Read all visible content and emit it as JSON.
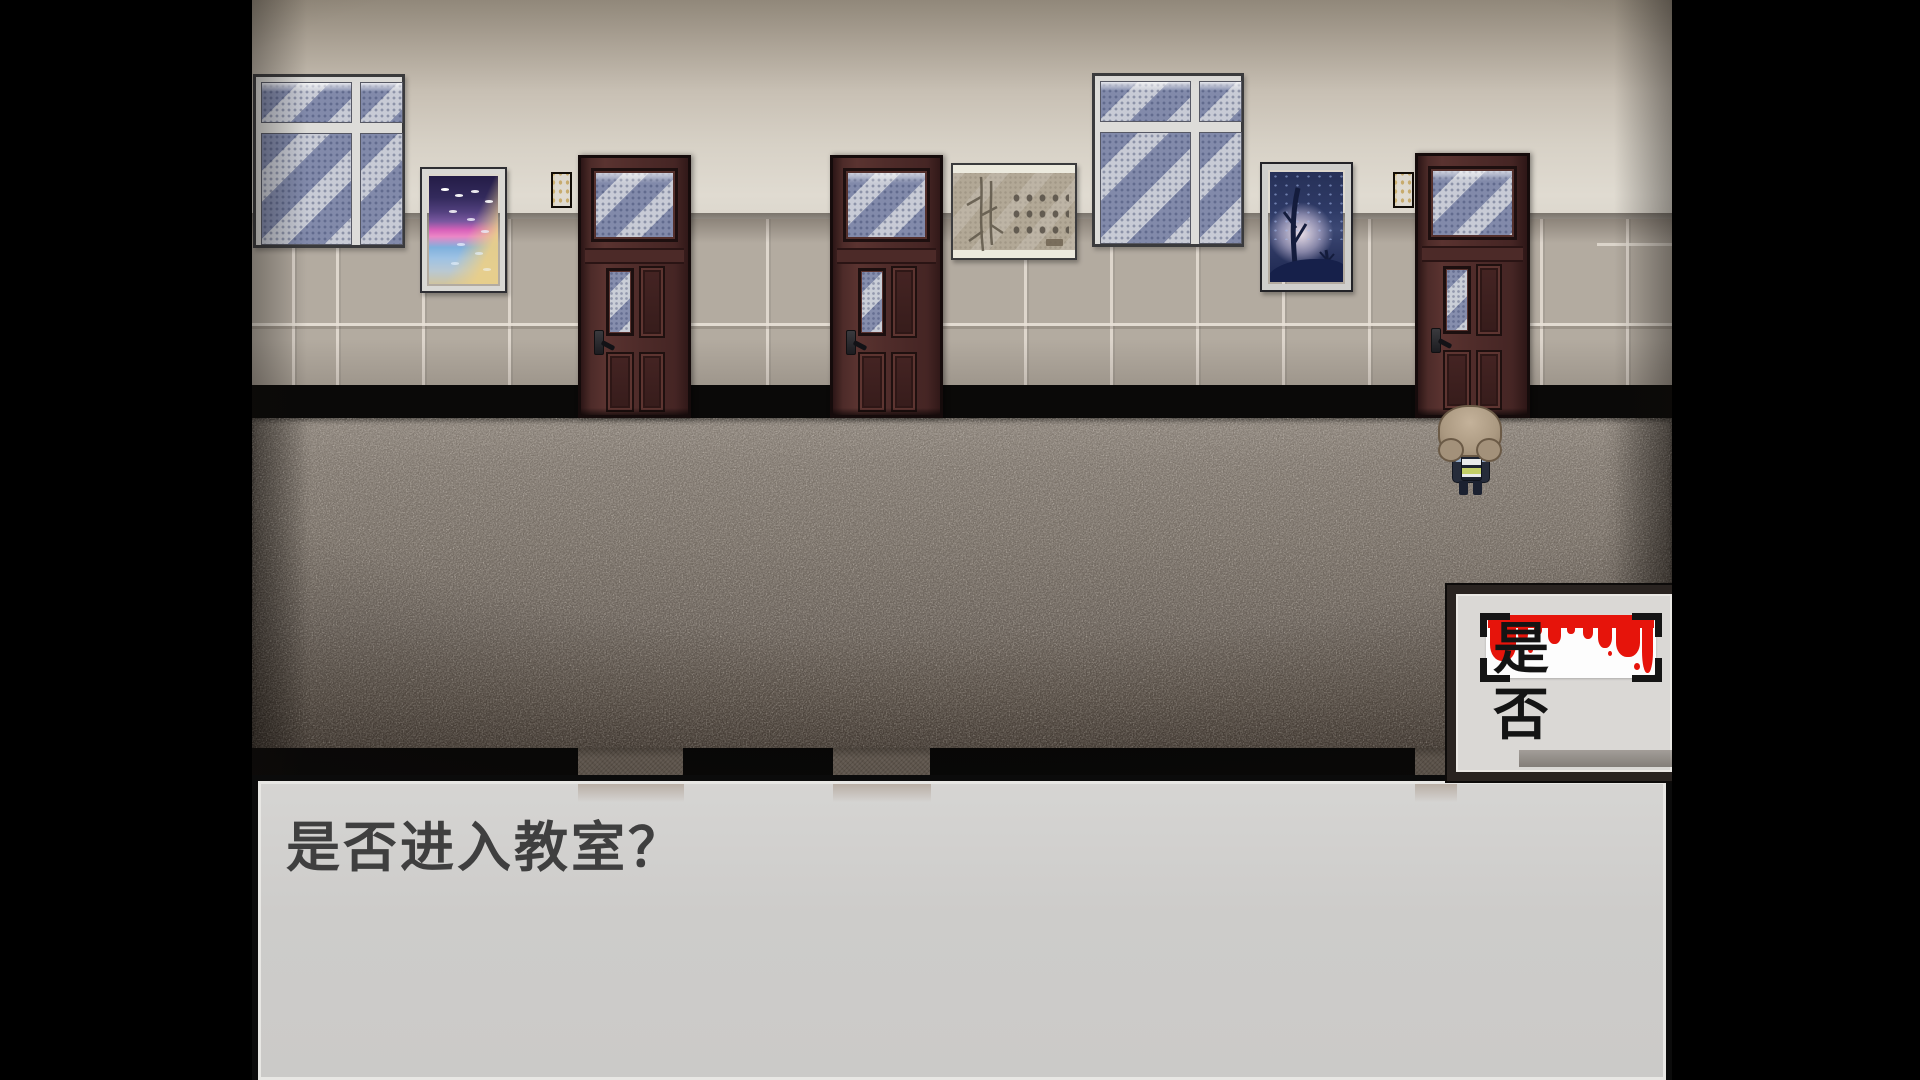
{
  "dialogue": {
    "text": "是否进入教室？"
  },
  "choices": {
    "options": [
      {
        "label": "是",
        "selected": true
      },
      {
        "label": "否",
        "selected": false
      }
    ],
    "selected_index": 0
  },
  "scene": {
    "type": "school-hallway",
    "player": "pixel character with fluffy tan hair and dark uniform, seen from behind at the right classroom door",
    "door_count": 3,
    "window_count": 2,
    "plaque_count": 2,
    "posters": [
      "seaside-sunset-painting",
      "calligraphy-scroll",
      "night-trees-painting"
    ],
    "colors": {
      "letterbox": "#000000",
      "wall_top": "#a1988a",
      "wall_light": "#e0dbd1",
      "tile": "#b3aba0",
      "grout": "#e5ded4",
      "floor_light": "#968e86",
      "floor_dark": "#483f38",
      "door": "#4e2b29",
      "glass": "#c7cad4",
      "ui_background": "#d1d0ce",
      "ui_border": "#0b0b0b",
      "blood_red": "#e6140b",
      "text": "#3f3f3f"
    }
  }
}
